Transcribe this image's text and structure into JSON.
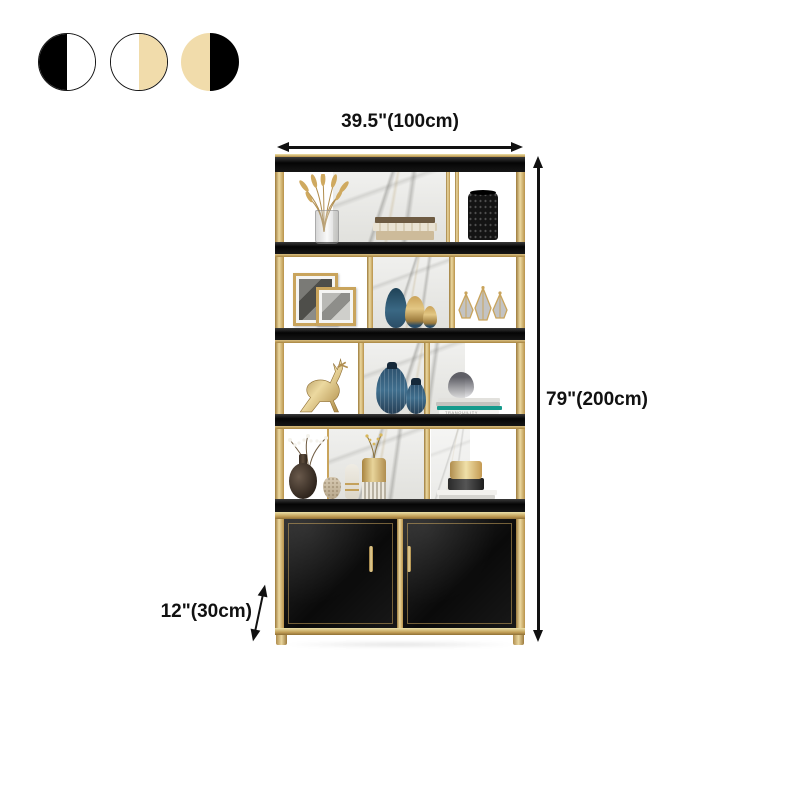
{
  "swatches": [
    {
      "id": "black-white",
      "left": "#000000",
      "right": "#ffffff"
    },
    {
      "id": "white-cream",
      "left": "#ffffff",
      "right": "#f1dcab"
    },
    {
      "id": "cream-black",
      "left": "#f1dcab",
      "right": "#000000"
    }
  ],
  "dimensions": {
    "width": "39.5\"(100cm)",
    "height": "79\"(200cm)",
    "depth": "12\"(30cm)"
  },
  "decor": {
    "book_spine": "TRANQUILITY"
  },
  "colors": {
    "gold": "#c9a45c",
    "gold-light": "#ecd9a0",
    "gold-dark": "#9c7a3c",
    "shelf-black": "#111111",
    "cream": "#f1dcab",
    "marble": "#ebebe8",
    "vase-blue": "#3a6080",
    "book-teal": "#159a8c",
    "arrow": "#111111"
  }
}
